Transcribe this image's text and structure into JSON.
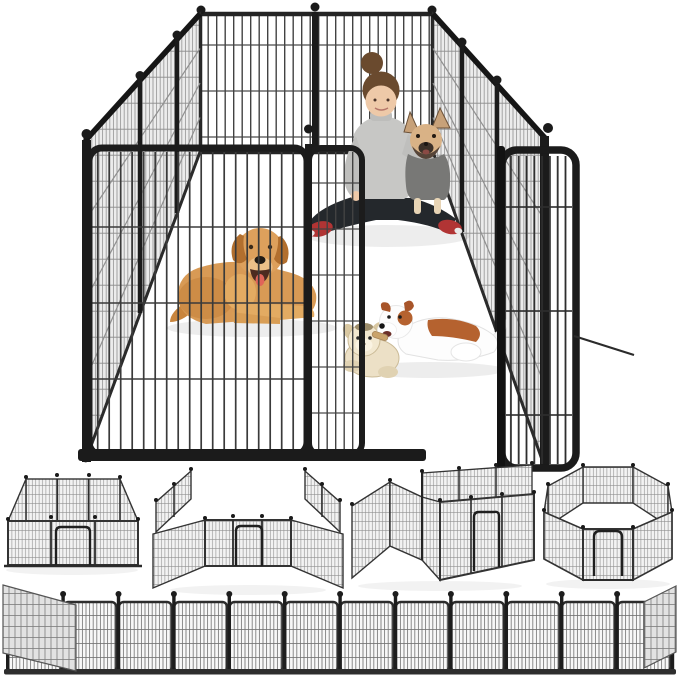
{
  "page": {
    "kind": "product-photo",
    "description": "Heavy-duty metal dog playpen fence shown assembled as a large pen with open gate; a woman holding a French bulldog, a golden retriever and a Jack Russell puppy with a plush toy sit inside; below are four alternate panel configurations and a straight fence row"
  },
  "colors": {
    "fence": "#1b1b1b",
    "fence_frame": "#242424",
    "wire": "#3a3a3a",
    "side_mesh_bg": "#ececec",
    "sweater": "#c7c7c5",
    "sweater_shade": "#bfbfbd",
    "hair": "#6a4a2e",
    "skin": "#eec9a8",
    "leggings": "#24282c",
    "shoes": "#b13434",
    "frenchie_coat": "#d9b286",
    "frenchie_mask": "#564438",
    "frenchie_sweater": "#787876",
    "retriever_coat": "#d89a55",
    "retriever_ear": "#b26f2e",
    "retriever_tongue": "#e06459",
    "puppy_white": "#fdfdfd",
    "puppy_brown": "#b5622f",
    "plush_cream": "#ece0c6",
    "shadow": "rgba(0,0,0,0.07)"
  },
  "scene": {
    "main_playpen": {
      "label": "assembled playpen with open gate door",
      "occupants": [
        {
          "name": "woman-holding-french-bulldog"
        },
        {
          "name": "golden-retriever-lying"
        },
        {
          "name": "jack-russell-puppy-with-plush-toy"
        }
      ]
    },
    "configurations": [
      {
        "name": "rectangle-pen"
      },
      {
        "name": "open-sided-pen"
      },
      {
        "name": "zigzag-rooms-pen"
      },
      {
        "name": "octagon-pen"
      }
    ],
    "straight_fence": {
      "panel_count": 12,
      "post_count": 13,
      "angled_end_panels": 2
    }
  }
}
